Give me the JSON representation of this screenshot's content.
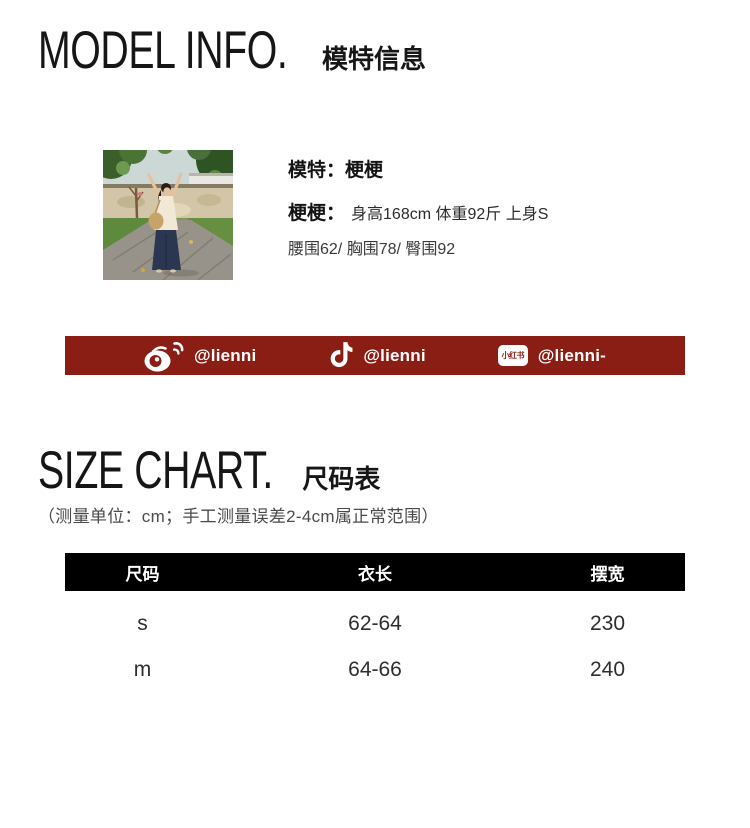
{
  "model_info": {
    "title_en": "MODEL INFO.",
    "title_zh": "模特信息",
    "model_line": "模特：梗梗",
    "stats_label": "梗梗：",
    "stats_value": "身高168cm 体重92斤 上身S",
    "measurements": "腰围62/ 胸围78/ 臀围92"
  },
  "social_banner": {
    "bg_color": "#8B1E14",
    "items": [
      {
        "icon": "weibo-icon",
        "handle": "@lienni"
      },
      {
        "icon": "douyin-icon",
        "handle": "@lienni"
      },
      {
        "icon": "xiaohongshu-icon",
        "icon_text": "小红书",
        "handle": "@lienni-"
      }
    ]
  },
  "size_chart": {
    "title_en": "SIZE CHART.",
    "title_zh": "尺码表",
    "note": "（测量单位：cm；手工测量误差2-4cm属正常范围）",
    "table": {
      "headers": [
        "尺码",
        "衣长",
        "摆宽"
      ],
      "rows": [
        [
          "s",
          "62-64",
          "230"
        ],
        [
          "m",
          "64-66",
          "240"
        ]
      ]
    }
  }
}
